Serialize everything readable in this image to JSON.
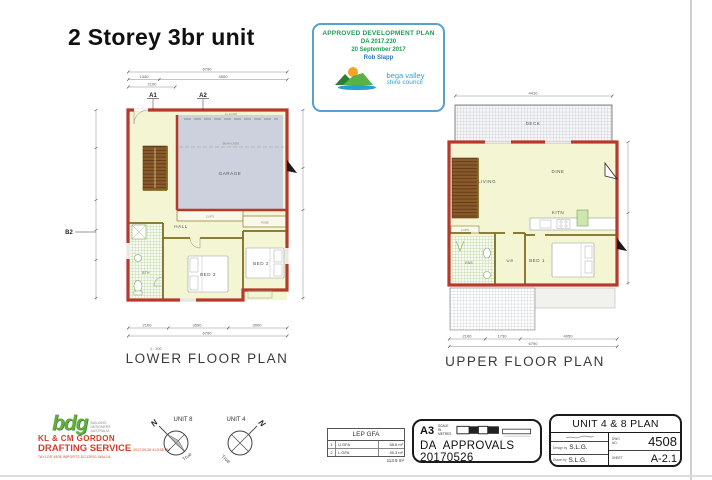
{
  "page": {
    "title": "2 Storey 3br unit"
  },
  "stamp": {
    "line1": "APPROVED DEVELOPMENT PLAN",
    "line2": "DA 2017.230",
    "line3": "20 September 2017",
    "line4": "Rob Slapp",
    "council_line1": "bega valley",
    "council_line2": "shire council"
  },
  "lower_plan": {
    "scale": "1 : 100",
    "title": "LOWER FLOOR PLAN",
    "markers": {
      "a1": "A1",
      "a2": "A2",
      "b2": "B2"
    },
    "rooms": {
      "garage": "GARAGE",
      "hall": "HALL",
      "bth": "BTH",
      "bed3": "BED 3",
      "bed2": "BED 2",
      "cups": "CUP'S",
      "robe": "ROBE"
    },
    "notes": {
      "ridge": "21.24 RID",
      "beam": "BEAM OVER"
    },
    "dims": {
      "top_overall": "6790",
      "top_seg1": "1340",
      "top_seg2": "4500",
      "top_sub": "2100",
      "bottom_seg1": "2100",
      "bottom_seg2": "3590",
      "bottom_seg3": "3000",
      "bottom_overall": "6790"
    }
  },
  "upper_plan": {
    "title": "UPPER FLOOR PLAN",
    "rooms": {
      "deck": "DECK",
      "living": "LIVING",
      "dine": "DINE",
      "kitn": "KITN",
      "ens": "ENS",
      "wir": "WIR",
      "bed1": "BED 1",
      "cups": "CUP'S"
    },
    "dims": {
      "top_overall": "4410",
      "bottom_seg1": "2100",
      "bottom_seg2": "1730",
      "bottom_seg3": "4050",
      "bottom_overall": "6790"
    }
  },
  "footer": {
    "drafting": {
      "logo": "bdg",
      "assoc1": "BUILDING",
      "assoc2": "DESIGNERS",
      "assoc3": "AUSTRALIA",
      "company1": "KL & CM GORDON",
      "company2": "DRAFTING SERVICE",
      "stamp_date": "2017-09-26 4:13:05 PM",
      "file_line": "TAYLOR 4508 IMPORTS DC12R01 WALLA"
    },
    "compass1": {
      "unit": "UNIT 8",
      "n": "N",
      "true_label": "True"
    },
    "compass2": {
      "unit": "UNIT 4",
      "n": "N",
      "true_label": "True"
    },
    "lep": {
      "title": "LEP GFA",
      "rows": [
        {
          "num": "1",
          "label": "U.GFA",
          "value": "68.6 m²"
        },
        {
          "num": "2",
          "label": "L.GFA",
          "value": "45.3 m²"
        }
      ],
      "total": "113.9 m²"
    },
    "approvals": {
      "sheet": "A3",
      "scale_label1": "SCALE IN",
      "scale_label2": "METRES",
      "text": "DA APPROVALS 20170526"
    },
    "title_block": {
      "title": "UNIT 4 & 8 PLAN",
      "design_label": "Design by",
      "design_value": "S.L.G.",
      "drawn_label": "Drawn by",
      "drawn_value": "S.L.G.",
      "dwg_label1": "DWG",
      "dwg_label2": "NO.",
      "dwg_value": "4508",
      "sheet_label": "SHEET",
      "sheet_value": "A-2.1"
    }
  }
}
